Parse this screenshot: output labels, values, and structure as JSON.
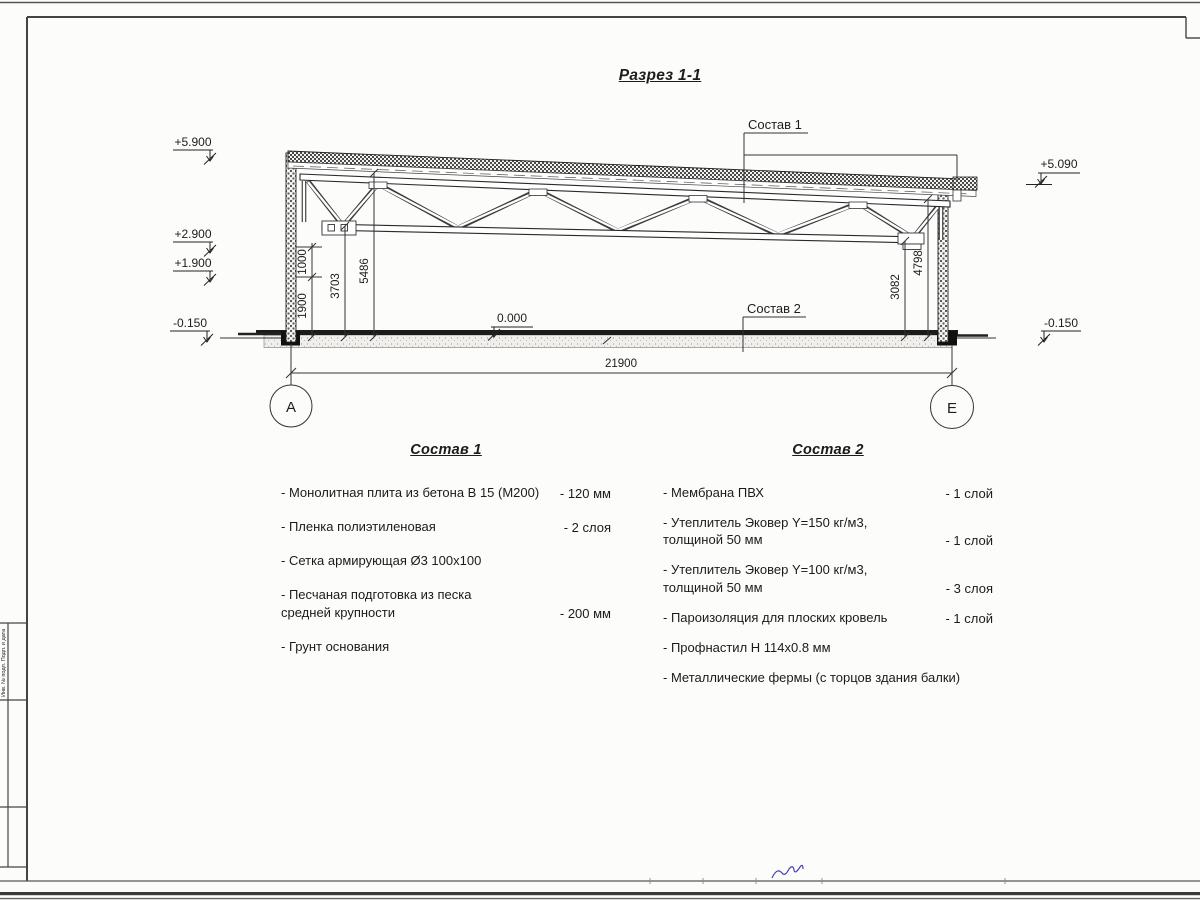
{
  "title": "Разрез 1-1",
  "callouts": {
    "c1": "Состав 1",
    "c2": "Состав 2"
  },
  "elevation_marks": {
    "p5900": "+5.900",
    "p2900": "+2.900",
    "p1900": "+1.900",
    "m0150_left": "-0.150",
    "zero": "0.000",
    "p5090": "+5.090",
    "m0150_right": "-0.150"
  },
  "dimensions": {
    "d1900": "1900",
    "d1000": "1000",
    "d3703": "3703",
    "d5486": "5486",
    "d3082": "3082",
    "d4798": "4798",
    "d21900": "21900"
  },
  "axes": {
    "left": "А",
    "right": "Е"
  },
  "lists": {
    "sostav1": {
      "title": "Состав 1",
      "items": [
        {
          "name": "- Монолитная плита из бетона В 15 (М200)",
          "value": "- 120 мм"
        },
        {
          "name": "- Пленка полиэтиленовая",
          "value": "-  2 слоя"
        },
        {
          "name": "- Сетка армирующая Ø3 100х100",
          "value": ""
        },
        {
          "name": "- Песчаная подготовка из песка\nсредней крупности",
          "value": "- 200 мм"
        },
        {
          "name": "- Грунт основания",
          "value": ""
        }
      ]
    },
    "sostav2": {
      "title": "Состав 2",
      "items": [
        {
          "name": "- Мембрана ПВХ",
          "value": "- 1 слой"
        },
        {
          "name": "- Утеплитель Эковер Y=150 кг/м3,\nтолщиной 50 мм",
          "value": "- 1 слой"
        },
        {
          "name": "- Утеплитель Эковер Y=100 кг/м3,\nтолщиной 50 мм",
          "value": "- 3 слоя"
        },
        {
          "name": "- Пароизоляция для плоских кровель",
          "value": "- 1 слой"
        },
        {
          "name": "- Профнастил Н 114х0.8 мм",
          "value": ""
        },
        {
          "name": "- Металлические фермы (с торцов здания балки)",
          "value": ""
        }
      ]
    }
  },
  "frame": {
    "stamp_side_text": "Инв. № подл.  Подп. и дата"
  }
}
